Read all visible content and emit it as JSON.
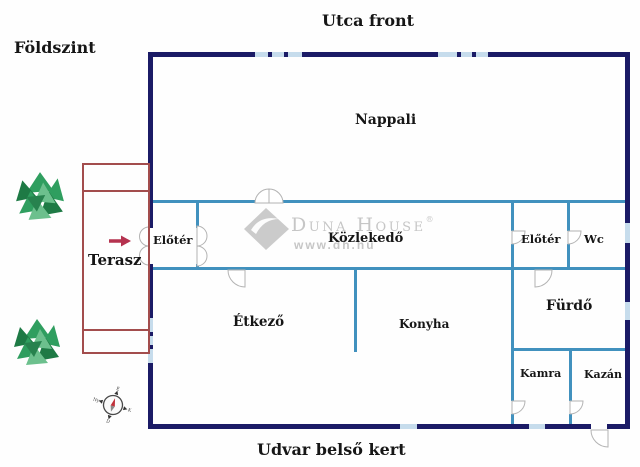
{
  "page": {
    "top_label": "Utca front",
    "bottom_label": "Udvar belső kert",
    "floor_label": "Földszint"
  },
  "rooms": {
    "nappali": "Nappali",
    "eloter1": "Előtér",
    "kozlekedo": "Közlekedő",
    "eloter2": "Előtér",
    "wc": "Wc",
    "terasz": "Terasz",
    "etkezo": "Étkező",
    "konyha": "Konyha",
    "furdo": "Fürdő",
    "kamra": "Kamra",
    "kazan": "Kazán"
  },
  "watermark": {
    "brand": "Duna House",
    "registered": "®",
    "url": "www.dh.hu"
  },
  "compass": {
    "north": "É",
    "east": "K",
    "south": "D",
    "west": "Ny"
  },
  "colors": {
    "exterior_wall": "#1b1b66",
    "interior_wall": "#4191be",
    "window": "#c6dcec",
    "terrace": "#a34d4d",
    "arrow": "#b5324f",
    "tree_dark": "#1e7a45",
    "tree_mid": "#2f9e5f",
    "tree_light": "#6cc08d",
    "watermark": "#c6c6c6",
    "label": "#161616",
    "door_line": "#b3b3b3"
  }
}
